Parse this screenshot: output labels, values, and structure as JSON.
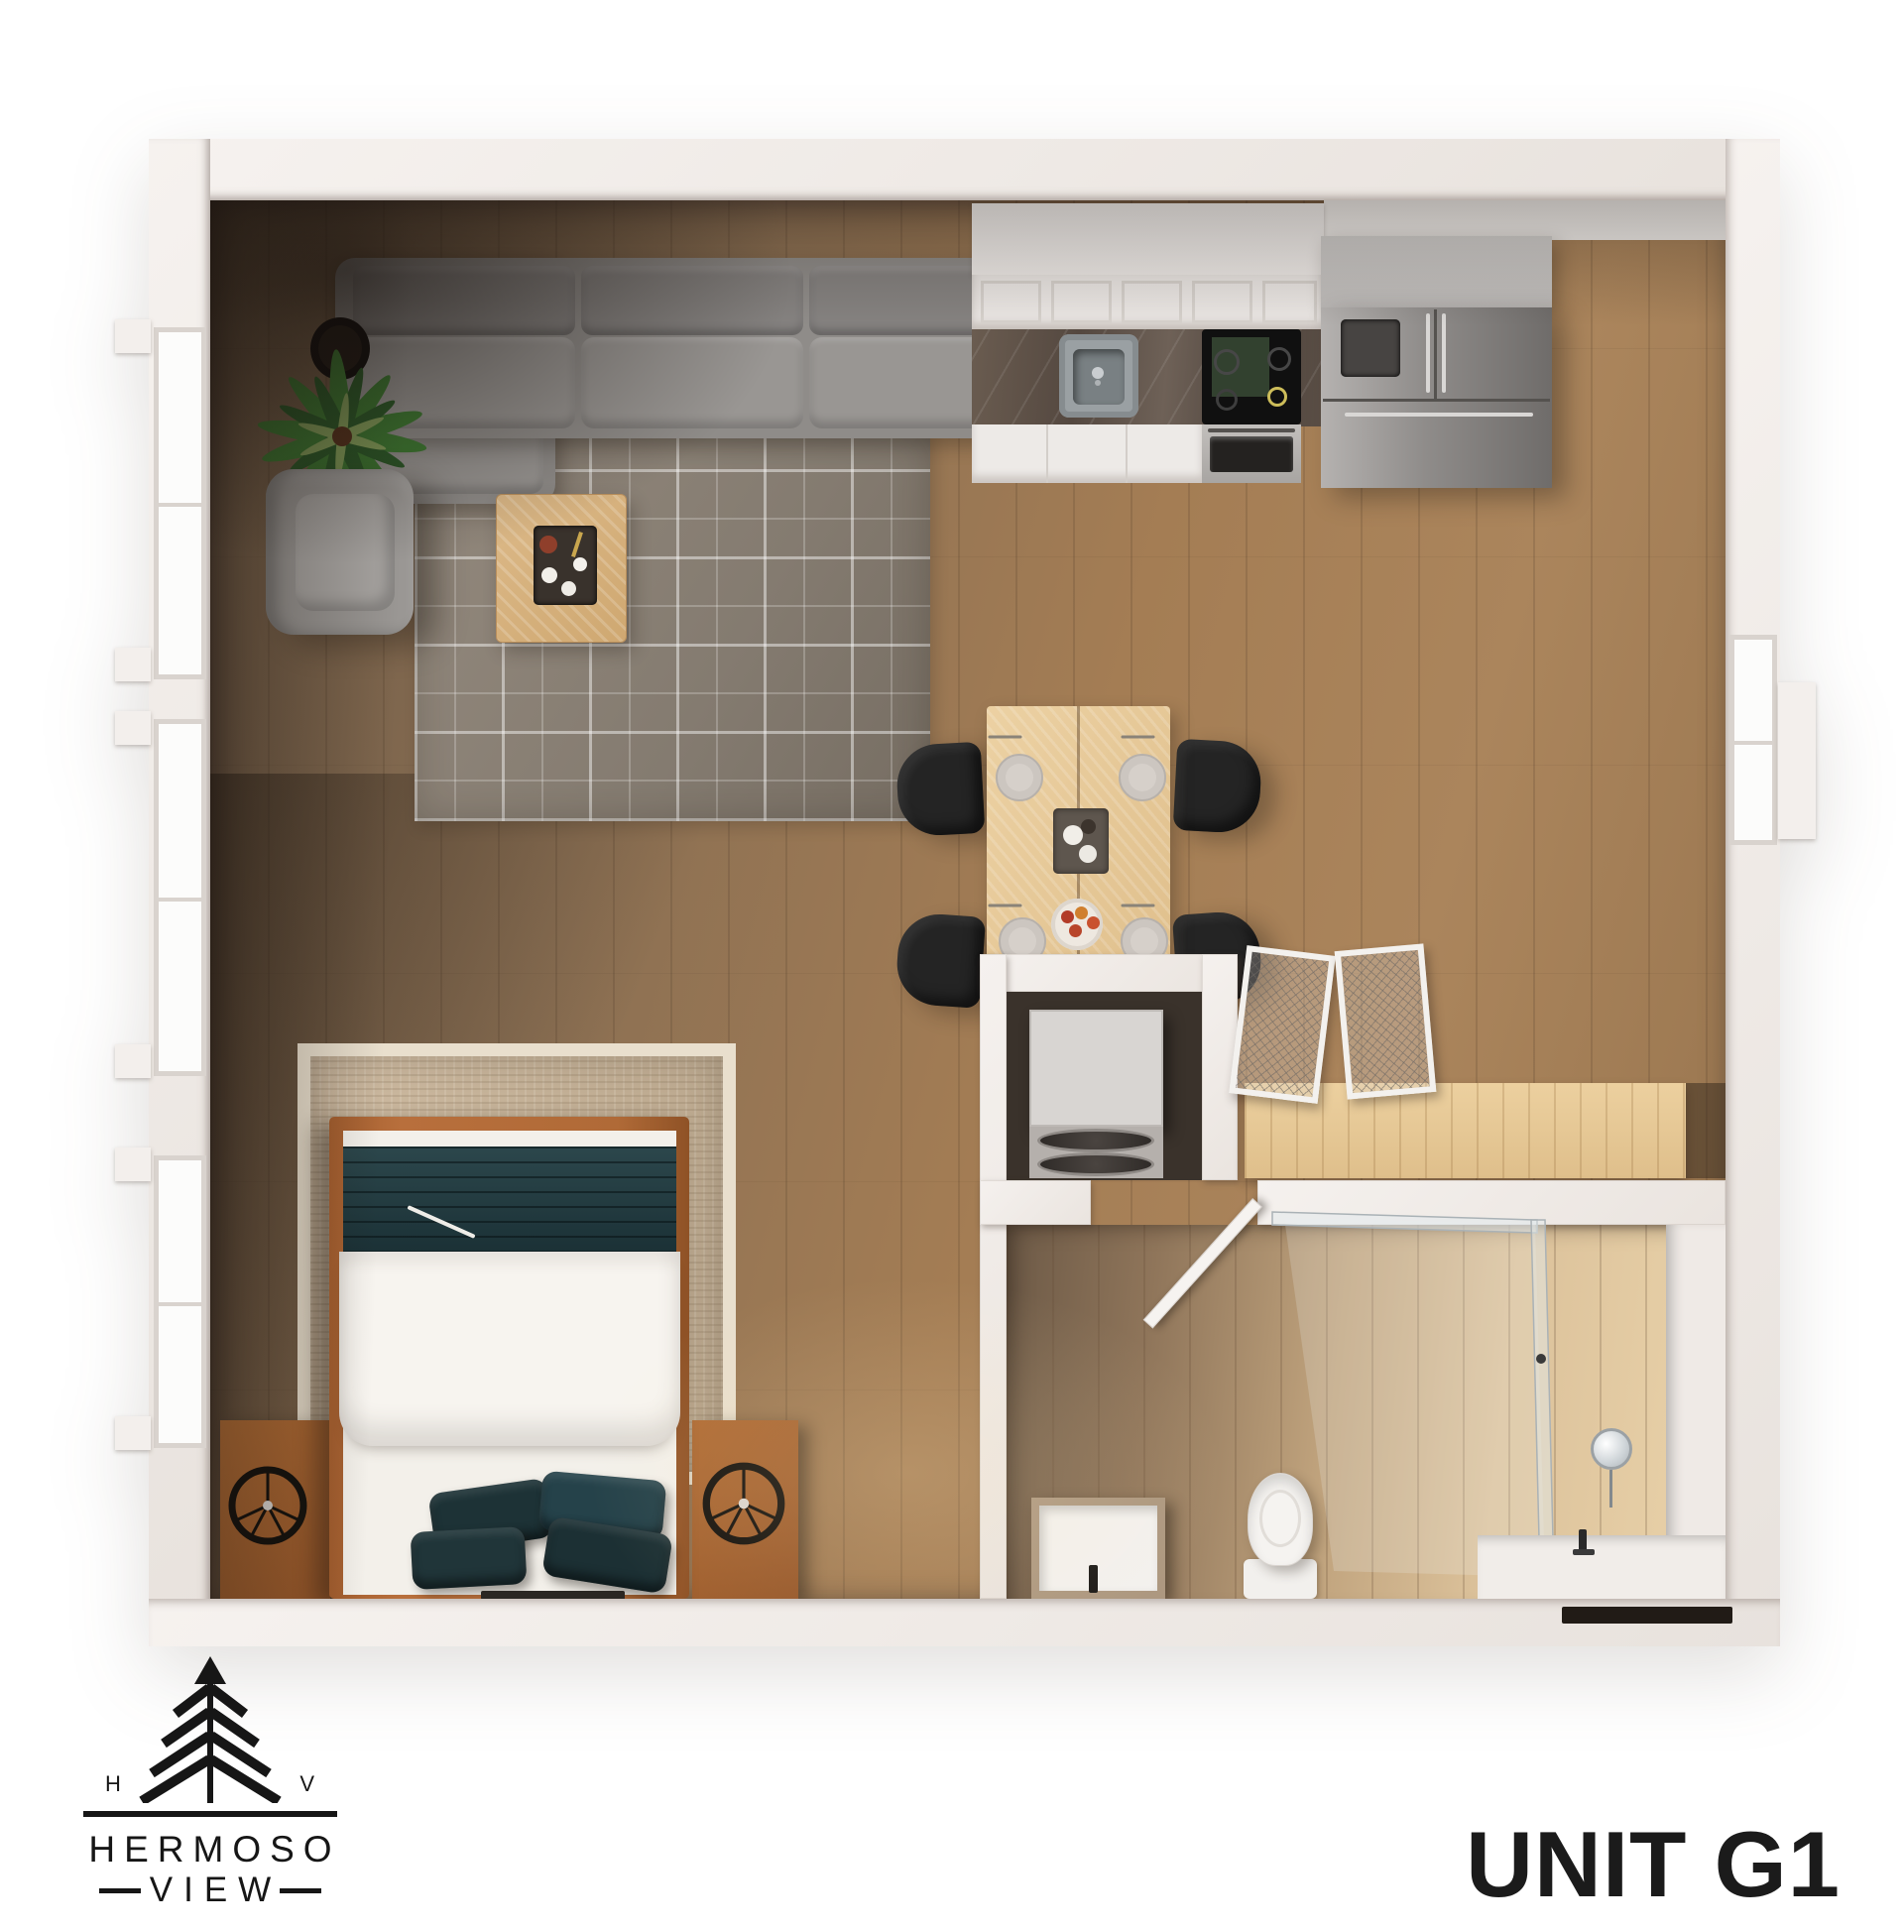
{
  "branding": {
    "monogram_left": "H",
    "monogram_right": "V",
    "wordmark_top": "HERMOSO",
    "wordmark_bottom": "VIEW"
  },
  "unit": {
    "label": "UNIT G1"
  },
  "palette": {
    "page_bg": "#ffffff",
    "wall": "#f1ece8",
    "wood_floor": "#9a7550",
    "bath_floor": "#d8c0a0",
    "living_rug": "#8b8278",
    "bedroom_rug": "#c8b59c",
    "sofa_gray": "#8f8c89",
    "dining_chair_black": "#242424",
    "dining_table_wood": "#e8cb9b",
    "bed_frame_wood": "#b0693a",
    "accent_teal": "#22393e",
    "counter_marble": "#5a4f46",
    "stainless": "#8f8c8a",
    "logo_ink": "#161616",
    "title_ink": "#1b1b1b"
  },
  "floorplan": {
    "view": "3D top-down unit rendering",
    "rooms": [
      "living area",
      "kitchen",
      "dining area",
      "bedroom area",
      "laundry closet",
      "closet",
      "bathroom"
    ],
    "furniture": [
      "sectional sofa",
      "armchair",
      "coffee table",
      "area rug",
      "potted plants",
      "upper cabinets",
      "sink",
      "cooktop with oven",
      "refrigerator",
      "dining table for four",
      "black dining chairs",
      "stacked washer dryer",
      "closet shelf with wire doors",
      "queen bed",
      "nightstands with wheel clocks",
      "toilet",
      "stone sink",
      "vanity with round mirror",
      "glass shower"
    ]
  }
}
